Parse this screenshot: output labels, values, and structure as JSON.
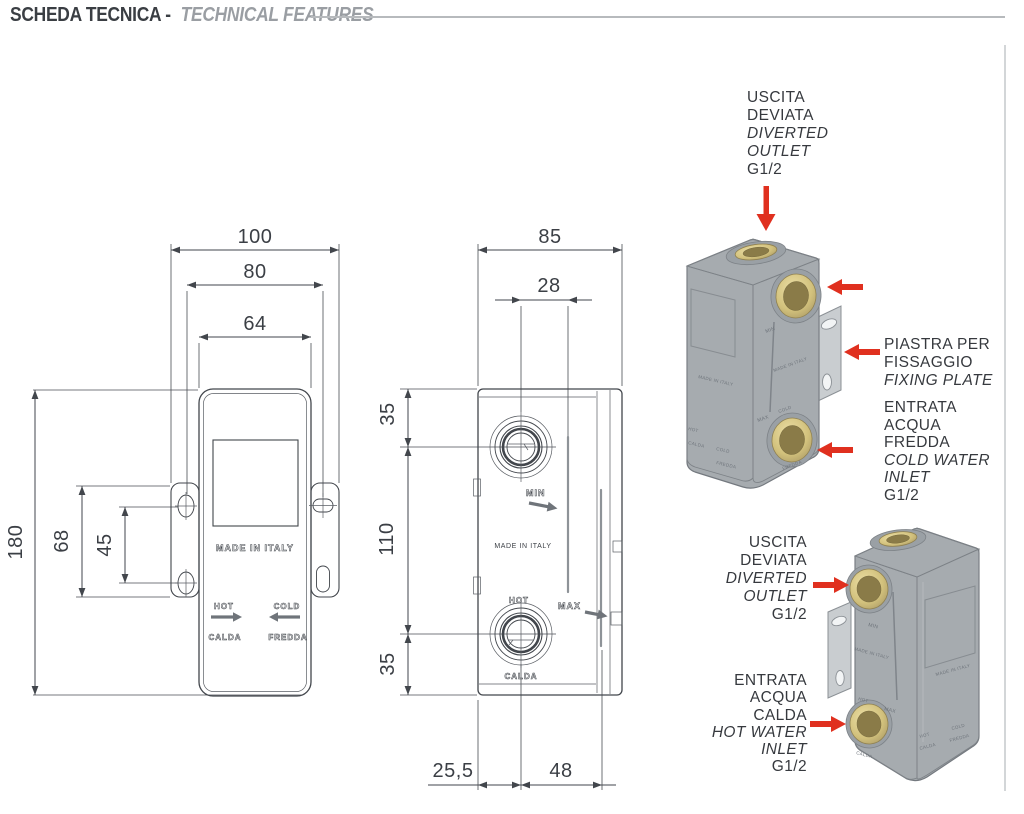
{
  "header": {
    "title_left": "SCHEDA TECNICA -",
    "title_right": "TECHNICAL FEATURES"
  },
  "front_view": {
    "dims": {
      "outer_width": "100",
      "hole_spacing_h": "80",
      "body_width": "64",
      "body_height": "180",
      "plate_height": "68",
      "hole_spacing_v": "45"
    },
    "engravings": {
      "made_in_italy": "MADE IN ITALY",
      "hot": "HOT",
      "calda": "CALDA",
      "cold": "COLD",
      "fredda": "FREDDA"
    }
  },
  "side_view": {
    "dims": {
      "depth": "85",
      "port_offset": "28",
      "top_to_port": "35",
      "port_spacing": "110",
      "port_to_bottom": "35",
      "bottom_left": "25,5",
      "bottom_right": "48"
    },
    "engravings": {
      "min": "MIN",
      "max": "MAX",
      "made_in_italy": "MADE IN ITALY",
      "hot": "HOT",
      "calda": "CALDA"
    }
  },
  "renders": {
    "engravings": {
      "made_in_italy": "MADE IN ITALY",
      "min": "MIN",
      "max": "MAX",
      "hot": "HOT",
      "calda": "CALDA",
      "cold": "COLD",
      "fredda": "FREDDA"
    }
  },
  "callouts": {
    "top_outlet": {
      "l1": "USCITA",
      "l2": "DEVIATA",
      "l3": "DIVERTED",
      "l4": "OUTLET",
      "l5": "G1/2"
    },
    "fixing_plate": {
      "l1": "PIASTRA PER",
      "l2": "FISSAGGIO",
      "l3": "FIXING PLATE"
    },
    "cold_inlet": {
      "l1": "ENTRATA",
      "l2": "ACQUA",
      "l3": "FREDDA",
      "l4": "COLD WATER",
      "l5": "INLET",
      "l6": "G1/2"
    },
    "side_outlet": {
      "l1": "USCITA",
      "l2": "DEVIATA",
      "l3": "DIVERTED",
      "l4": "OUTLET",
      "l5": "G1/2"
    },
    "hot_inlet": {
      "l1": "ENTRATA",
      "l2": "ACQUA",
      "l3": "CALDA",
      "l4": "HOT WATER",
      "l5": "INLET",
      "l6": "G1/2"
    }
  },
  "colors": {
    "accent_red": "#E0301F",
    "line": "#42464C",
    "brass": "#D6C57F",
    "body_gray": "#A6ABAF",
    "title_gray": "#9A9EA2"
  }
}
